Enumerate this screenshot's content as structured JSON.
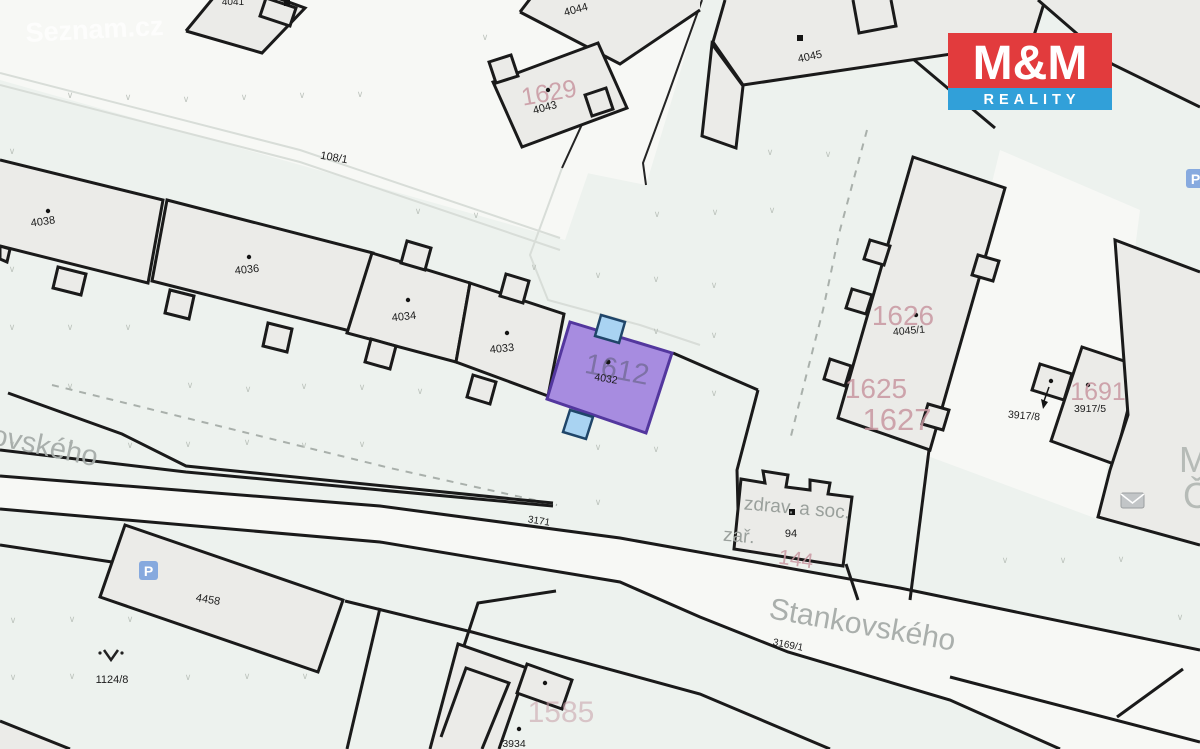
{
  "labels": {
    "p4041": "4041",
    "p4044": "4044",
    "p4043": "4043",
    "p4045": "4045",
    "p108_1": "108/1",
    "p4038": "4038",
    "p4036": "4036",
    "p4034": "4034",
    "p4033": "4033",
    "p4032": "4032",
    "p4045_1": "4045/1",
    "p3917_8": "3917/8",
    "p3917_5": "3917/5",
    "p94": "94",
    "p3171": "3171",
    "p4458": "4458",
    "p1124_8": "1124/8",
    "p3169_1": "3169/1",
    "p3934": "3934",
    "n1629": "1629",
    "n1612": "1612",
    "n1626": "1626",
    "n1625": "1625",
    "n1627": "1627",
    "n1691": "1691",
    "n1585": "1585",
    "n144": "144",
    "facility_line1": "zdrav. a soc.",
    "facility_line2": "zař.",
    "street_main": "Stankovského",
    "street_partial": "ovského",
    "edge_m": "M",
    "edge_c": "Č"
  },
  "watermark": {
    "text": "Seznam.cz"
  },
  "logo": {
    "top": "M&M",
    "bottom": "REALITY",
    "red": "#e23b3d",
    "blue": "#31a0d9"
  },
  "icons": {
    "parking": "P",
    "envelope": "envelope-icon",
    "survey_mark": "survey-point-icon",
    "arrow": "arrow-down-icon"
  },
  "colors": {
    "background": "#edf2ee",
    "road": "#f7f8f5",
    "building_fill": "#ebebe8",
    "outline": "#1a1a1a",
    "highlight_fill": "#a78ce0",
    "highlight_stroke": "#53379e",
    "blue_annex_fill": "#a9d3f2",
    "pink_text": "#c897a1",
    "gray_text": "#9aa09c",
    "street_text": "#a6aca9"
  },
  "vegetation": {
    "glyph": "∨",
    "points": [
      [
        70,
        98
      ],
      [
        128,
        100
      ],
      [
        186,
        102
      ],
      [
        244,
        100
      ],
      [
        302,
        98
      ],
      [
        360,
        97
      ],
      [
        485,
        40
      ],
      [
        12,
        154
      ],
      [
        770,
        155
      ],
      [
        828,
        157
      ],
      [
        418,
        214
      ],
      [
        476,
        218
      ],
      [
        657,
        217
      ],
      [
        715,
        215
      ],
      [
        772,
        213
      ],
      [
        12,
        272
      ],
      [
        534,
        270
      ],
      [
        598,
        278
      ],
      [
        656,
        282
      ],
      [
        714,
        288
      ],
      [
        12,
        330
      ],
      [
        70,
        330
      ],
      [
        128,
        330
      ],
      [
        656,
        334
      ],
      [
        714,
        338
      ],
      [
        70,
        389
      ],
      [
        190,
        388
      ],
      [
        248,
        392
      ],
      [
        304,
        389
      ],
      [
        362,
        390
      ],
      [
        420,
        394
      ],
      [
        478,
        397
      ],
      [
        656,
        392
      ],
      [
        714,
        396
      ],
      [
        12,
        447
      ],
      [
        71,
        447
      ],
      [
        130,
        448
      ],
      [
        188,
        447
      ],
      [
        247,
        445
      ],
      [
        304,
        448
      ],
      [
        362,
        447
      ],
      [
        598,
        450
      ],
      [
        656,
        452
      ],
      [
        598,
        505
      ],
      [
        1005,
        563
      ],
      [
        1063,
        563
      ],
      [
        1121,
        562
      ],
      [
        1180,
        620
      ],
      [
        13,
        623
      ],
      [
        72,
        622
      ],
      [
        130,
        622
      ],
      [
        13,
        680
      ],
      [
        72,
        679
      ],
      [
        188,
        680
      ],
      [
        247,
        679
      ],
      [
        305,
        679
      ]
    ]
  }
}
